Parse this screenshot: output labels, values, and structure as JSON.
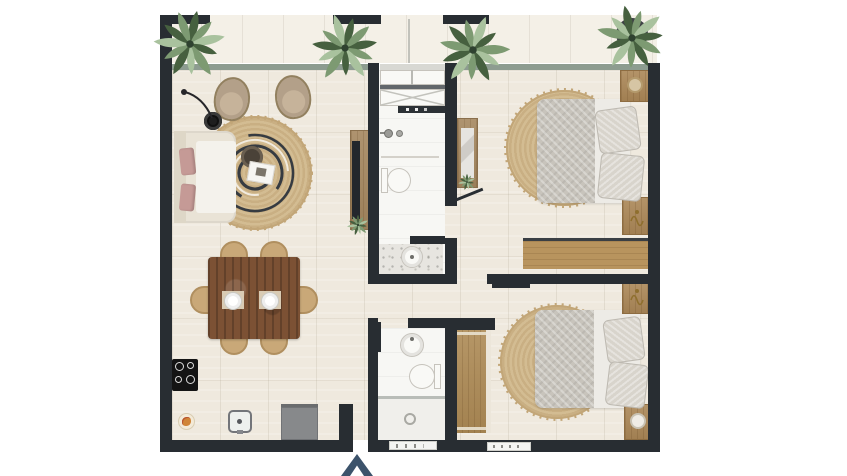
{
  "scene": {
    "type": "apartment-floor-plan-top-view",
    "background": "#ffffff",
    "entrance_indicator": {
      "shape": "chevron-up",
      "color": "#3c536b"
    }
  },
  "colors": {
    "wall": "#282d32",
    "window": "#8d9c90",
    "bathWindow": "#d8d8d3",
    "floor": "#efe9de",
    "floorLine": "#d8d0bf",
    "balcony": "#f4f0e7",
    "bathFloor": "#f7f7f4",
    "terrazzo": "#e7e5e0",
    "woodConsole": "#a5875f",
    "woodTable": "#7c5134",
    "woodChair": "#c9a878",
    "woodNightstand": "#ab8757",
    "woodWardrobe": "#b8945e",
    "woodCloset": "#ad8a55",
    "rug": "#d3bc92",
    "rugRing": "#c9af83",
    "rugFringe": "#c2a678",
    "spiral": "#363b41",
    "duvet": "#c8c4bc",
    "sheet": "#edebe6",
    "pillowBed": "#d8d4cc",
    "sofa": "#e9e3d6",
    "sofaSeat": "#f4f2ec",
    "sofaPillow": "#c59a96",
    "armchair": "#b3a089",
    "arrow": "#3c536b",
    "appliance": "#87898b",
    "cooktop": "#141414",
    "plantDark": "#46603f",
    "plantMid": "#7d9a72",
    "plantLight": "#a9c29e",
    "gold": "#8f6f2e",
    "fixtureWhite": "#f9f9f6",
    "fixtureBorder": "#c6c3bc"
  },
  "inventory": {
    "balcony": [
      "plant",
      "plant",
      "plant",
      "plant",
      "railing-segments"
    ],
    "living_room": [
      "sofa-with-pink-cushions",
      "floor-lamp",
      "armchair",
      "armchair",
      "round-jute-rug-with-spiral",
      "coffee-table",
      "tray",
      "tv-console-with-tv",
      "dining-table-wood",
      "dining-chairs-x6",
      "place-setting",
      "place-setting"
    ],
    "kitchen": [
      "cooktop-4-burner",
      "sink",
      "refrigerator",
      "serving-plate"
    ],
    "bathroom_top": [
      "mirror-cabinet",
      "shower-x-glass",
      "shelf-with-toiletries",
      "vanity-faucets",
      "toilet",
      "pedestal-sink"
    ],
    "bathroom_bottom": [
      "round-sink",
      "toilet",
      "shower-with-drain",
      "control-shelf"
    ],
    "bedroom_top": [
      "double-bed-gray-duvet",
      "pillow",
      "pillow",
      "round-jute-rug",
      "nightstand",
      "nightstand",
      "dresser-with-mirror",
      "wardrobe"
    ],
    "bedroom_bottom": [
      "double-bed-gray-duvet",
      "pillow",
      "pillow",
      "round-jute-rug",
      "nightstand",
      "nightstand",
      "closet-wardrobe",
      "vent-strip"
    ]
  }
}
